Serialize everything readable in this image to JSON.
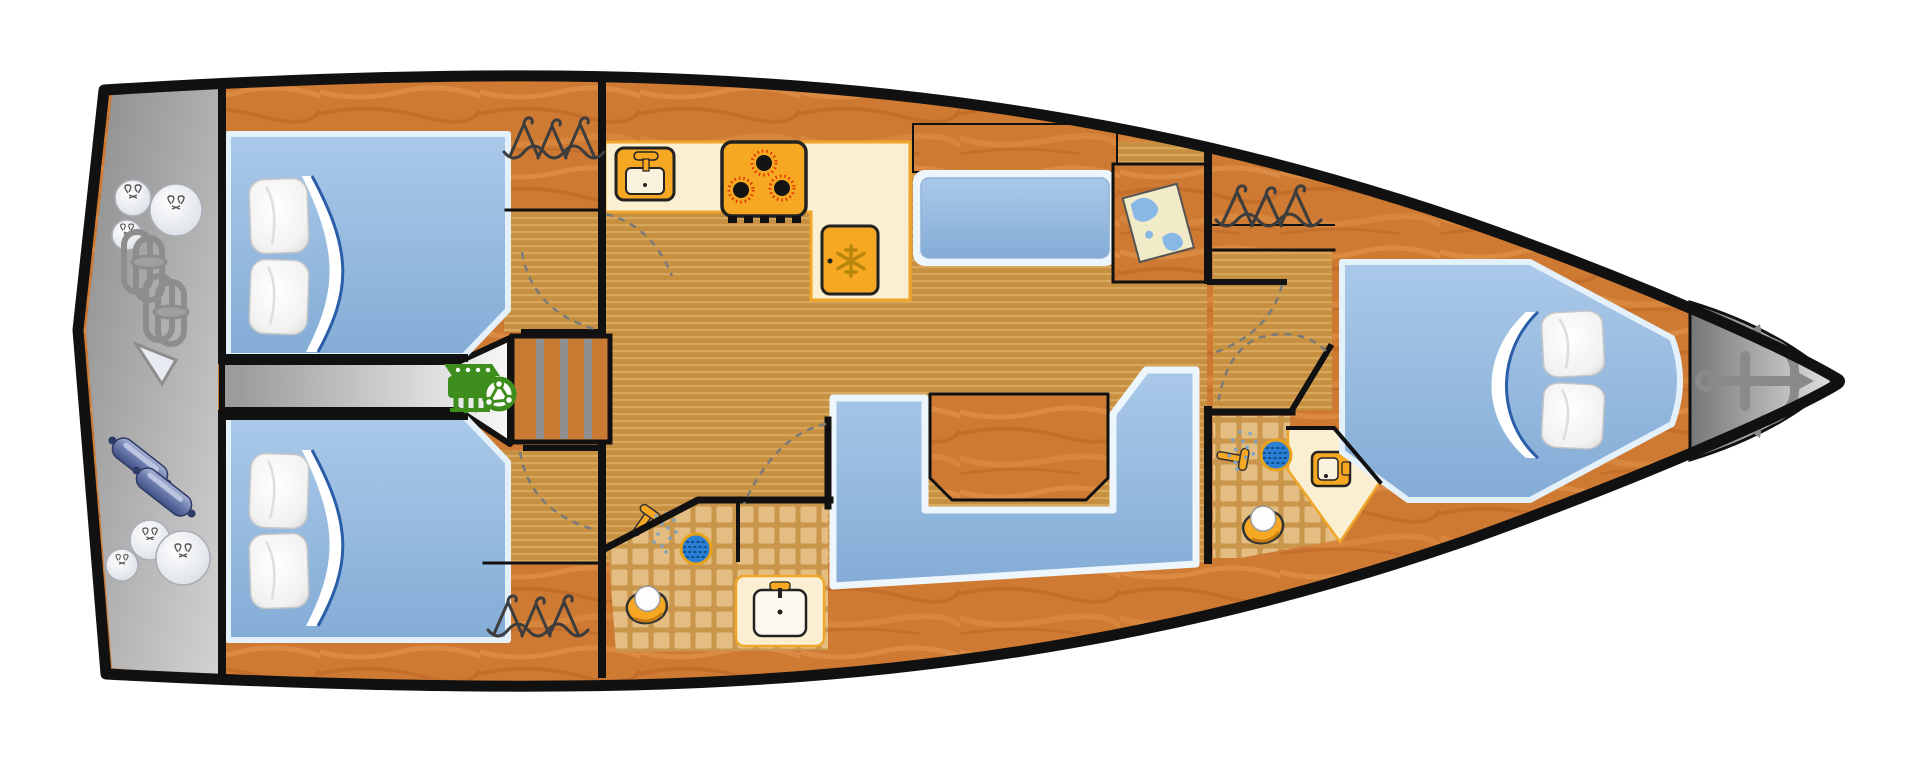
{
  "meta": {
    "description": "Top-down interior layout plan of a sailing yacht, bow pointing right, no text labels",
    "view": "top-down floor plan",
    "orientation": "bow-right, stern-left",
    "text_visible": false
  },
  "palette": {
    "hull_outline": "#111111",
    "wood": "#cf7a33",
    "wood_light": "#e0914a",
    "wood_dark": "#b96525",
    "floor_tan": "#c79040",
    "floor_stripe": "#d8a75e",
    "tile": "#c9964c",
    "tile_light": "#e3bd82",
    "upholstery_blue": "#8fb7de",
    "upholstery_glow": "#eef6fd",
    "counter_cream": "#faefd0",
    "counter_edge": "#f0a62a",
    "appliance_orange": "#f7a823",
    "engine_green": "#3e8e1d",
    "drain_blue": "#2a7fd4",
    "deck_gray": "#9a9a9a",
    "anchor_gray": "#8a8a8a",
    "fender_blue": "#5c6b9e",
    "pillow_white": "#ffffff",
    "duvet_accent_blue": "#2a5ea8",
    "door_arc_gray": "#7a7a7a"
  },
  "zones": [
    {
      "id": "stern-deck",
      "label": "Stern deck with fenders and mooring ropes",
      "items": [
        "three round fenders (top)",
        "two rope coils",
        "two blue sausage fenders",
        "three round fenders (bottom)"
      ]
    },
    {
      "id": "aft-cabin-top",
      "label": "Aft double cabin (top) with berth, two pillows, folded duvet, hanging locker",
      "items": [
        "double berth",
        "2 pillows",
        "duvet fold",
        "hanging locker",
        "door swing"
      ]
    },
    {
      "id": "aft-cabin-bottom",
      "label": "Aft double cabin (bottom) with berth, two pillows, folded duvet, hanging locker",
      "items": [
        "double berth",
        "2 pillows",
        "duvet fold",
        "hanging locker",
        "door swing"
      ]
    },
    {
      "id": "companionway",
      "label": "Companionway steps and engine compartment",
      "items": [
        "4 steps",
        "engine icon"
      ]
    },
    {
      "id": "galley",
      "label": "L-shaped galley with sink, 3-burner stove and refrigerator",
      "items": [
        "sink",
        "stove 3 burners",
        "refrigerator with snowflake"
      ]
    },
    {
      "id": "salon",
      "label": "Salon with straight settee, U-shaped settee and dining table",
      "items": [
        "straight settee",
        "U-shaped settee",
        "wood dining table"
      ]
    },
    {
      "id": "nav-station",
      "label": "Navigation station with chart table and nautical chart",
      "items": [
        "chart table",
        "nautical chart"
      ]
    },
    {
      "id": "aft-head",
      "label": "Mid-ship bathroom with shower, drain, toilet and washbasin",
      "items": [
        "shower head",
        "spray",
        "drain",
        "toilet",
        "washbasin on counter"
      ]
    },
    {
      "id": "forward-head",
      "label": "Forward bathroom with shower, drain, toilet and washbasin",
      "items": [
        "shower head",
        "spray",
        "drain",
        "toilet",
        "washbasin on counter"
      ]
    },
    {
      "id": "forward-cabin",
      "label": "Forward V-berth cabin with two pillows, folded duvet and hanging locker",
      "items": [
        "V-berth",
        "2 pillows",
        "duvet fold",
        "hanging locker",
        "door swings"
      ]
    },
    {
      "id": "anchor-locker",
      "label": "Bow anchor locker with anchor symbol",
      "items": [
        "anchor icon"
      ]
    }
  ],
  "icons": {
    "engine": "green engine block with belt pulley",
    "anchor": "gray anchor pointing toward bow",
    "snowflake": "refrigerator cold symbol",
    "hangers": "coat-hanger squiggles for wardrobes",
    "burners": "three stove burners",
    "drain": "round blue shower drain",
    "map": "nautical chart on nav table"
  }
}
